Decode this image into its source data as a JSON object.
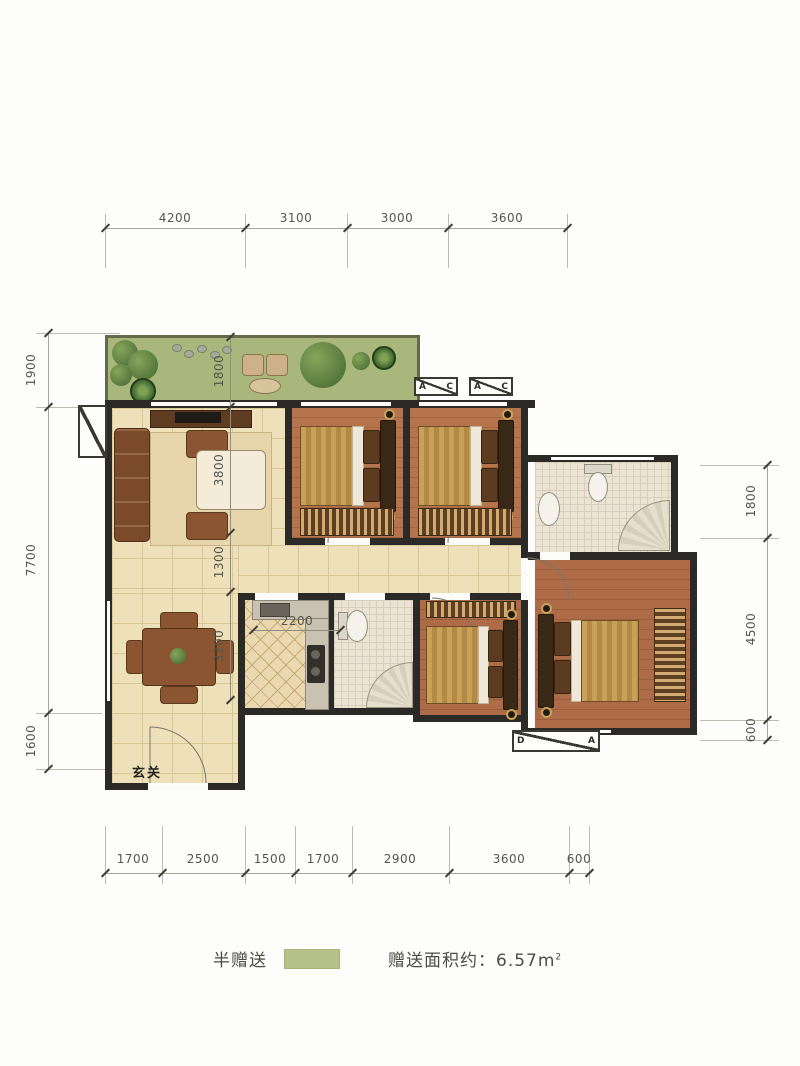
{
  "legend": {
    "half_gift_label": "半赠送",
    "gift_area_label": "赠送面积约：",
    "gift_area_value": "6.57",
    "gift_area_unit": "m",
    "gift_area_exp": "2",
    "swatch_color": "#b6c287"
  },
  "plan": {
    "entrance_label": "玄关",
    "window_tags": {
      "top_1": {
        "left": "A",
        "right": "C"
      },
      "top_2": {
        "left": "A",
        "right": "C"
      },
      "bottom": {
        "left": "D",
        "right": "A"
      }
    }
  },
  "dimensions": {
    "top": [
      "4200",
      "3100",
      "3000",
      "3600"
    ],
    "bottom": [
      "1700",
      "2500",
      "1500",
      "1700",
      "2900",
      "3600",
      "600"
    ],
    "left": [
      "1900",
      "7700",
      "1600"
    ],
    "right": [
      "1800",
      "4500",
      "600"
    ],
    "interior": {
      "balcony_depth": "1800",
      "living_width": "3800",
      "hall_width": "1300",
      "dining_width": "3200",
      "kitchen_width": "2200"
    }
  },
  "colors": {
    "wall": "#2c2a26",
    "balcony_green": "#a9b77d",
    "tile_floor": "#eee0b8",
    "wood_floor": "#b1714a",
    "legend_swatch": "#b6c287"
  }
}
